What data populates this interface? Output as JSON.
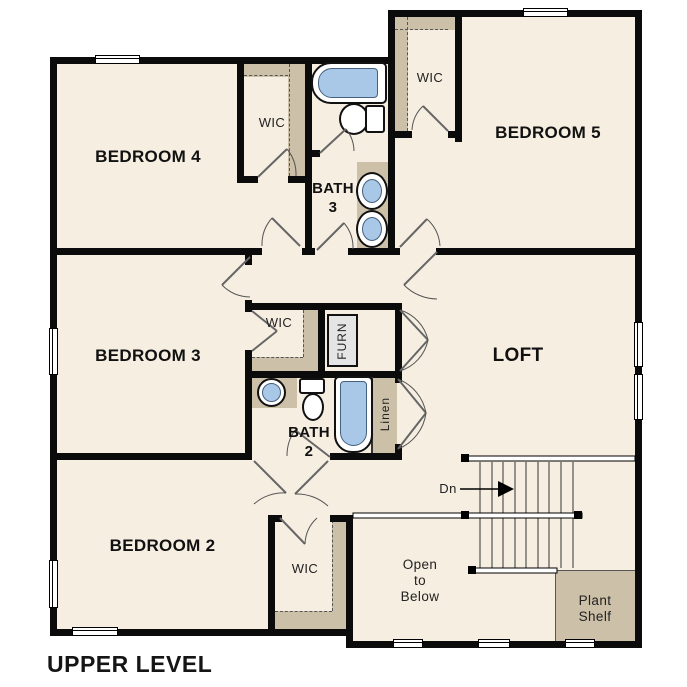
{
  "title": "UPPER LEVEL",
  "colors": {
    "floor": "#f6eee1",
    "shelf": "#ccc0a8",
    "wall": "#0b0b0b",
    "fixture_blue": "#a9c8e8",
    "furnace_gray": "#e5e5e5"
  },
  "rooms": {
    "bedroom4": "BEDROOM 4",
    "bedroom5": "BEDROOM 5",
    "bedroom3": "BEDROOM 3",
    "bedroom2": "BEDROOM 2",
    "loft": "LOFT",
    "bath3": "BATH\n3",
    "bath2": "BATH\n2",
    "wic4": "WIC",
    "wic5": "WIC",
    "wic3": "WIC",
    "wic2": "WIC",
    "furnace": "FURN",
    "linen": "Linen",
    "open_to_below": "Open\nto\nBelow",
    "plant_shelf": "Plant\nShelf"
  },
  "stairs": {
    "down_label": "Dn"
  }
}
